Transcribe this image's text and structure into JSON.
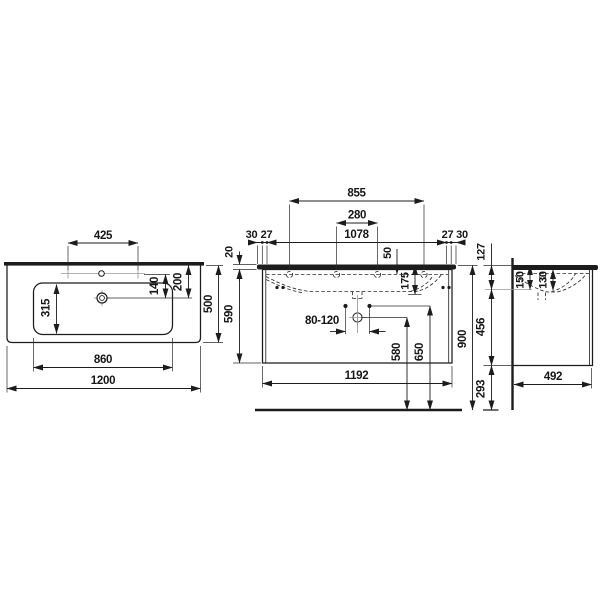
{
  "drawing": {
    "title": "Vanity washbasin with cabinet - dimension drawing",
    "top_view": {
      "tap_hole_spacing": "425",
      "drain_to_tap_row": "140",
      "drain_to_back_edge": "200",
      "bowl_depth": "315",
      "total_depth": "500",
      "bowl_width": "860",
      "total_width": "1200"
    },
    "front_view": {
      "hole_span_outer": "855",
      "hole_span_inner": "280",
      "chain": [
        "30",
        "27",
        "1078",
        "27",
        "30"
      ],
      "slab_thickness": "20",
      "rim_drop": "50",
      "bowl_inner_depth": "175",
      "unit_height": "590",
      "trap_offset_range": "80-120",
      "trap_height": "580",
      "supply_height": "650",
      "cabinet_width": "1192",
      "rim_height_above_floor": "900"
    },
    "side_view": {
      "outlet_below_rim": "127",
      "rim_to_outlet_axis": "150",
      "bowl_section_depth": "130",
      "cabinet_height": "456",
      "floor_clearance": "293",
      "cabinet_depth": "492"
    }
  }
}
